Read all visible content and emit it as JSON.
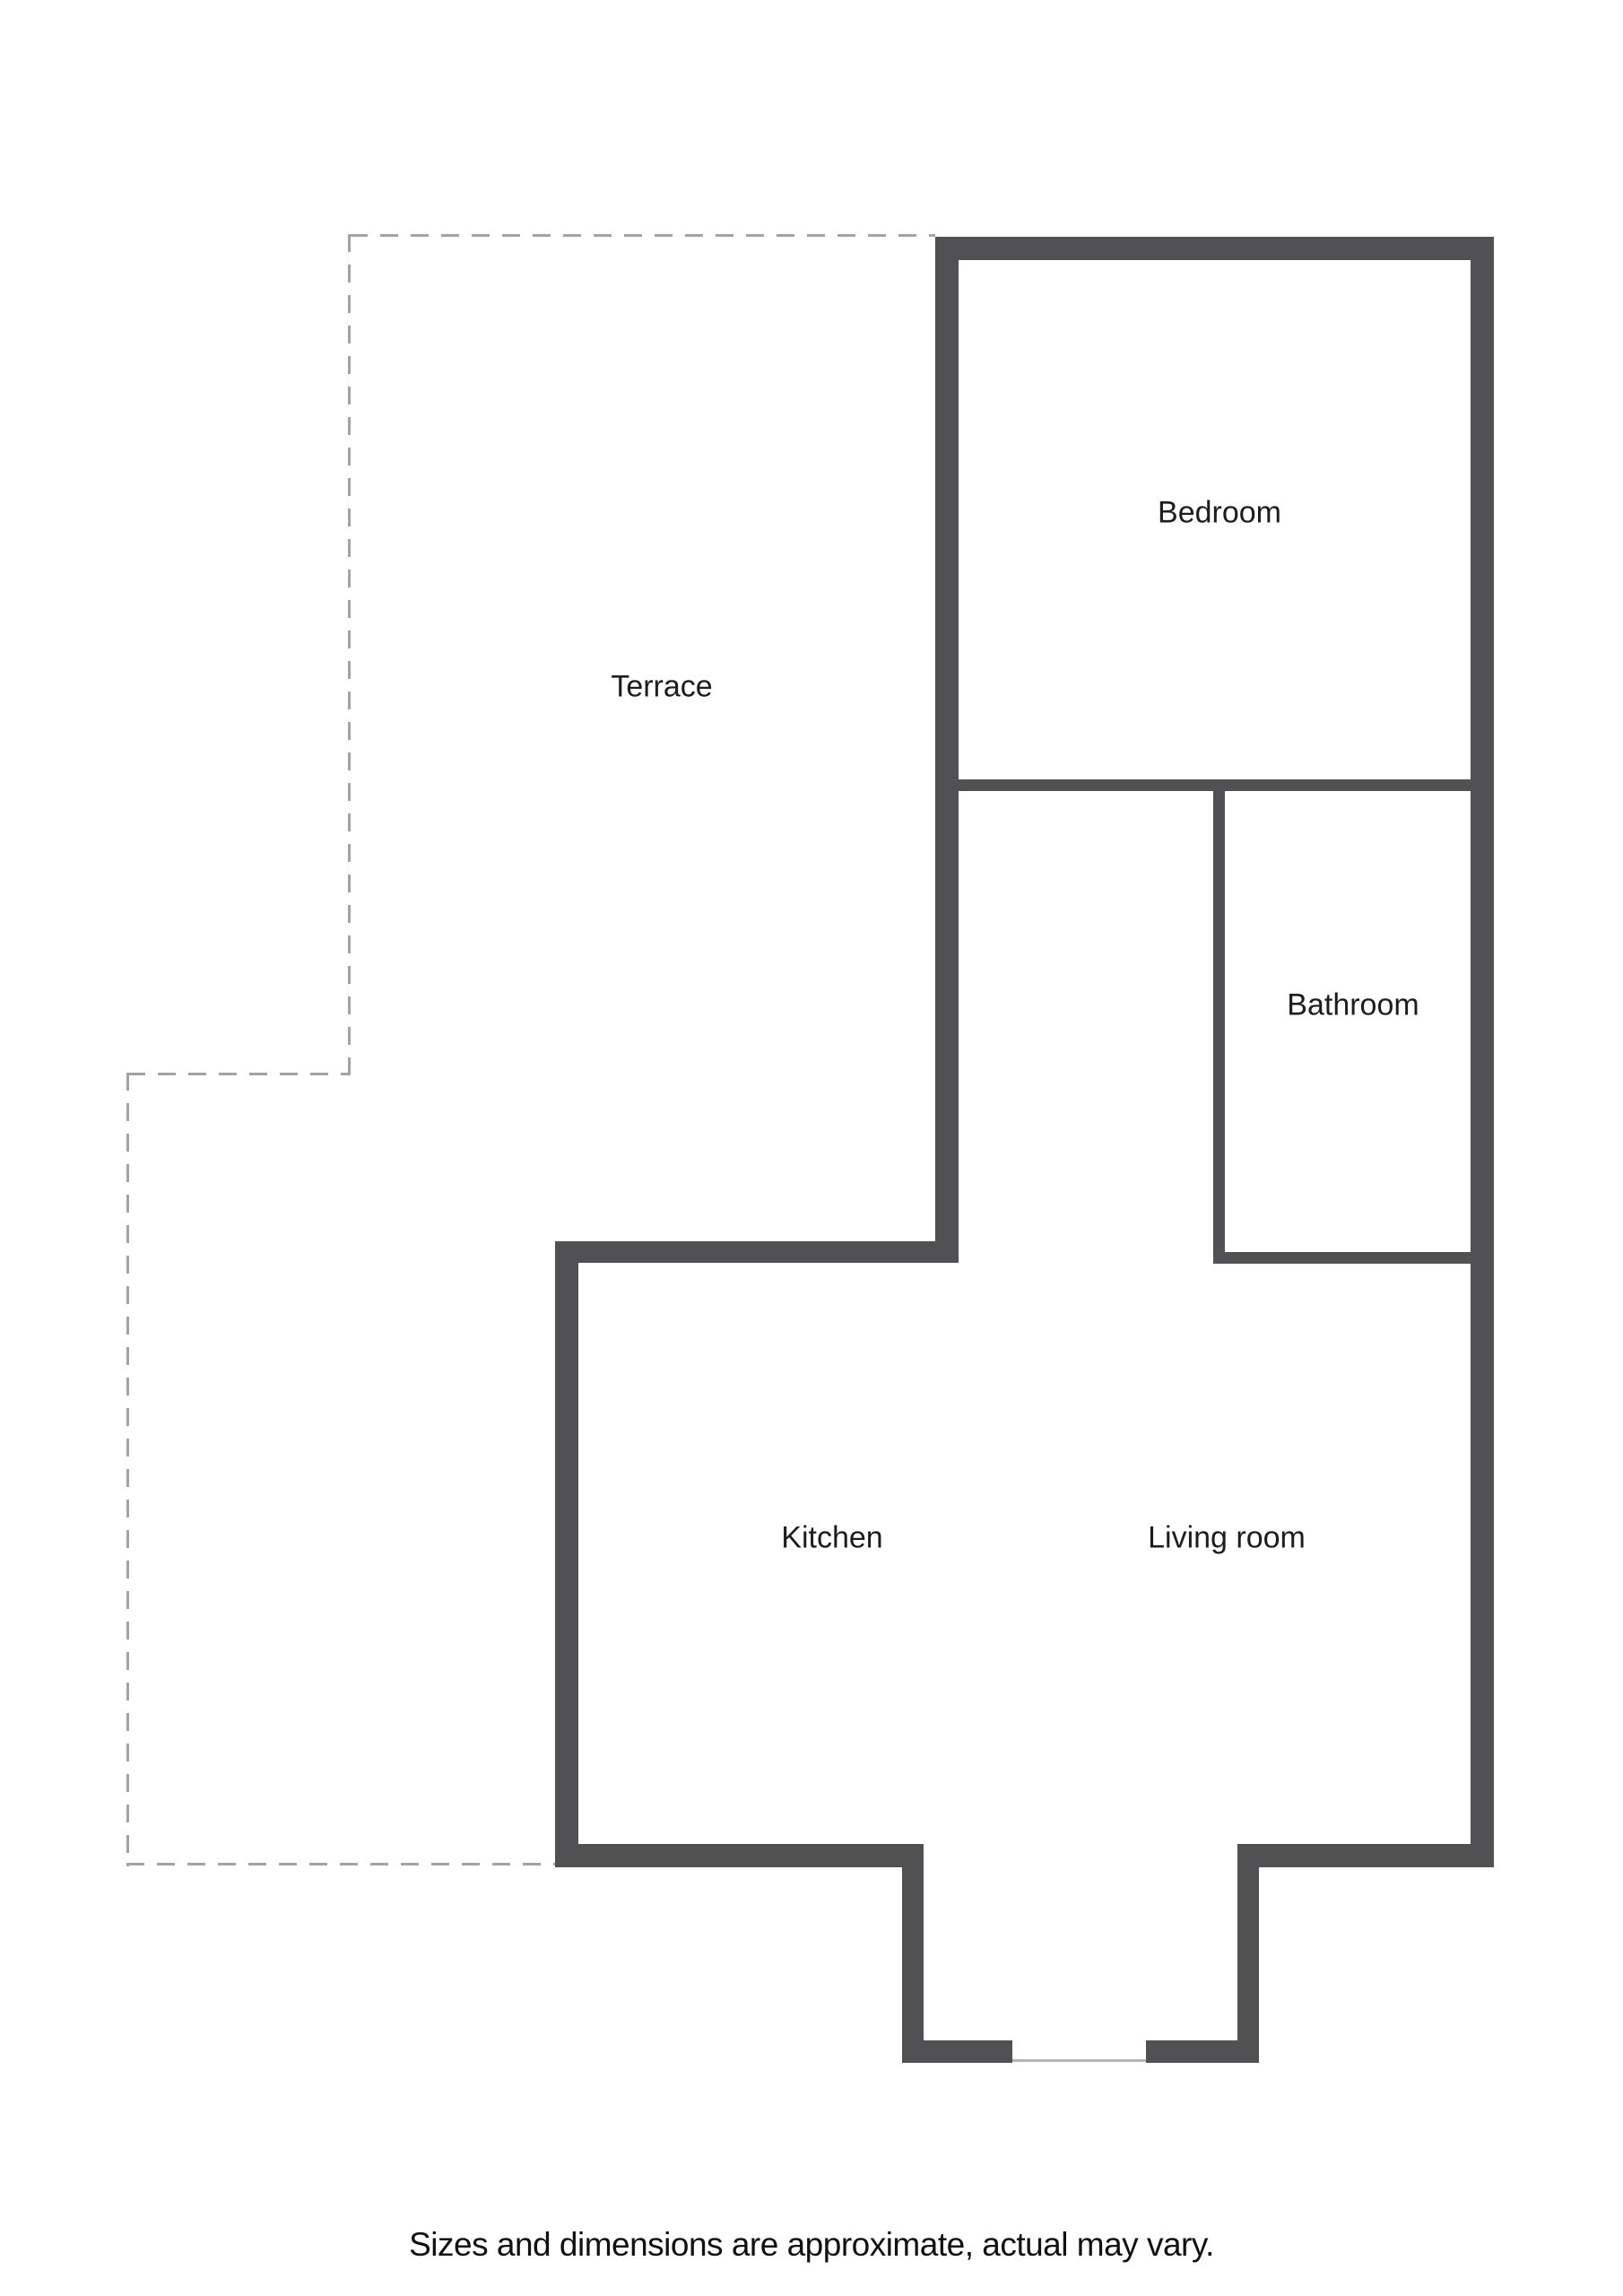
{
  "floorplan": {
    "rooms": {
      "terrace": "Terrace",
      "bedroom": "Bedroom",
      "bathroom": "Bathroom",
      "kitchen": "Kitchen",
      "living_room": "Living room"
    },
    "disclaimer": "Sizes and dimensions are approximate, actual may vary.",
    "colors": {
      "background": "#ffffff",
      "wall": "#515153",
      "dashed_outline": "#a3a3a3",
      "threshold": "#b5b5b5",
      "label_text": "#1d1d1d",
      "disclaimer_text": "#111111"
    }
  }
}
